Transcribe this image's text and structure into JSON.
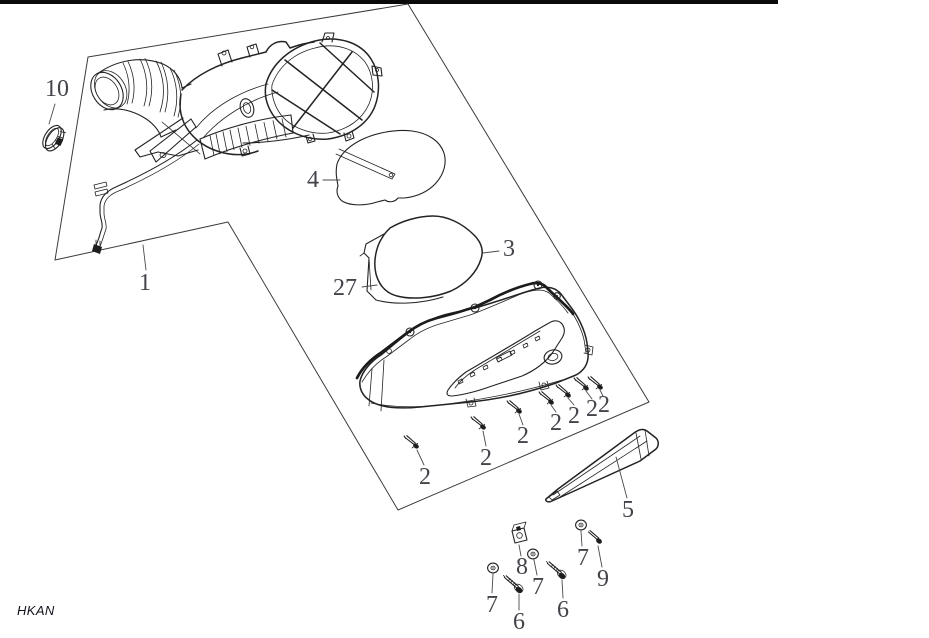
{
  "diagram": {
    "footer_code": "HKAN",
    "background": "#ffffff",
    "line_color": "#232323",
    "label_color": "#43434a",
    "top_bar_color": "#0a0a0a",
    "callouts": [
      {
        "id": "10",
        "text": "10",
        "x": 57,
        "y": 89,
        "leader": [
          55,
          104,
          49,
          124
        ]
      },
      {
        "id": "1",
        "text": "1",
        "x": 145,
        "y": 283,
        "leader": [
          146,
          270,
          143,
          245
        ]
      },
      {
        "id": "4",
        "text": "4",
        "x": 313,
        "y": 180,
        "leader": [
          323,
          180,
          340,
          180
        ]
      },
      {
        "id": "3",
        "text": "3",
        "x": 509,
        "y": 249,
        "leader": [
          499,
          251,
          483,
          253
        ]
      },
      {
        "id": "27",
        "text": "27",
        "x": 345,
        "y": 288,
        "leader": [
          362,
          287,
          377,
          285
        ]
      },
      {
        "id": "2a",
        "text": "2",
        "x": 425,
        "y": 477,
        "leader": [
          424,
          465,
          417,
          450
        ]
      },
      {
        "id": "2b",
        "text": "2",
        "x": 486,
        "y": 458,
        "leader": [
          486,
          446,
          483,
          431
        ]
      },
      {
        "id": "2c",
        "text": "2",
        "x": 523,
        "y": 436,
        "leader": [
          523,
          425,
          519,
          414
        ]
      },
      {
        "id": "2d",
        "text": "2",
        "x": 556,
        "y": 423,
        "leader": [
          556,
          412,
          551,
          405
        ]
      },
      {
        "id": "2e",
        "text": "2",
        "x": 574,
        "y": 416,
        "leader": [
          574,
          405,
          568,
          398
        ]
      },
      {
        "id": "2f",
        "text": "2",
        "x": 592,
        "y": 409,
        "leader": [
          592,
          399,
          586,
          391
        ]
      },
      {
        "id": "2g",
        "text": "2",
        "x": 604,
        "y": 405,
        "leader": [
          603,
          396,
          600,
          390
        ]
      },
      {
        "id": "5",
        "text": "5",
        "x": 628,
        "y": 510,
        "leader": [
          627,
          498,
          616,
          457
        ]
      },
      {
        "id": "7a",
        "text": "7",
        "x": 492,
        "y": 605,
        "leader": [
          492,
          593,
          493,
          574
        ]
      },
      {
        "id": "6a",
        "text": "6",
        "x": 519,
        "y": 622,
        "leader": [
          519,
          610,
          519,
          594
        ]
      },
      {
        "id": "8",
        "text": "8",
        "x": 522,
        "y": 567,
        "leader": [
          521,
          556,
          519,
          545
        ]
      },
      {
        "id": "7b",
        "text": "7",
        "x": 538,
        "y": 587,
        "leader": [
          537,
          575,
          534,
          560
        ]
      },
      {
        "id": "6b",
        "text": "6",
        "x": 563,
        "y": 610,
        "leader": [
          563,
          598,
          562,
          580
        ]
      },
      {
        "id": "7c",
        "text": "7",
        "x": 583,
        "y": 558,
        "leader": [
          582,
          546,
          581,
          531
        ]
      },
      {
        "id": "9",
        "text": "9",
        "x": 603,
        "y": 579,
        "leader": [
          602,
          567,
          598,
          546
        ]
      }
    ]
  }
}
